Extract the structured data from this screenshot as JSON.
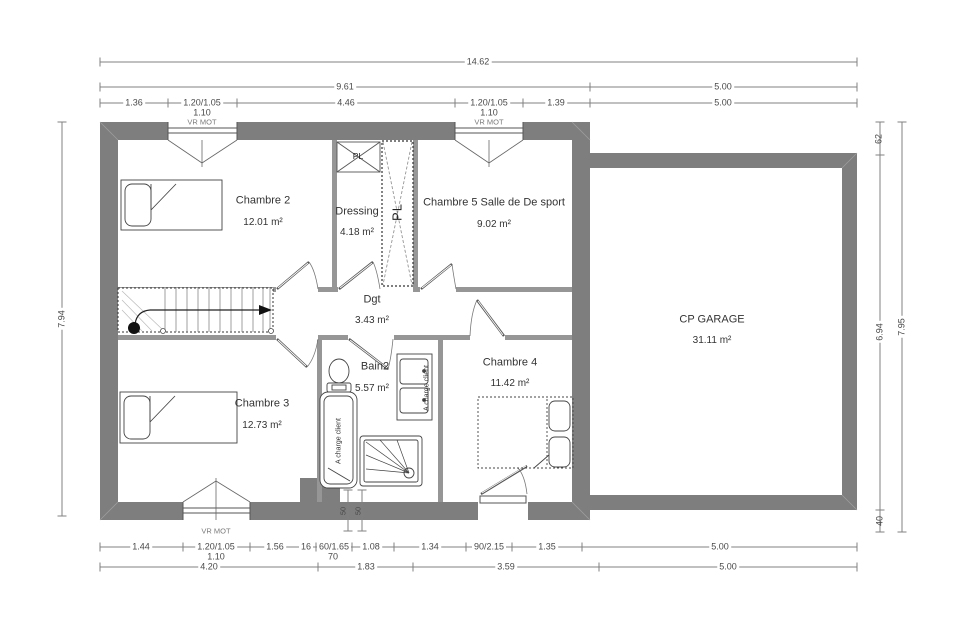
{
  "rooms": {
    "chambre2": {
      "name": "Chambre 2",
      "area": "12.01 m²"
    },
    "dressing": {
      "name": "Dressing",
      "area": "4.18 m²"
    },
    "chambre5": {
      "name": "Chambre 5 Salle de De sport",
      "area": "9.02 m²"
    },
    "dgt": {
      "name": "Dgt",
      "area": "3.43 m²"
    },
    "chambre3": {
      "name": "Chambre 3",
      "area": "12.73 m²"
    },
    "bain2": {
      "name": "Bain2",
      "area": "5.57 m²"
    },
    "chambre4": {
      "name": "Chambre 4",
      "area": "11.42 m²"
    },
    "garage": {
      "name": "CP GARAGE",
      "area": "31.11 m²"
    }
  },
  "closets": {
    "pl_box": "PL",
    "pl_column": "PL"
  },
  "fixtures": {
    "bathtub_note": "A charge client",
    "sink_note": "A charge client"
  },
  "windows": {
    "vr1": "VR MOT",
    "vr2": "VR MOT",
    "vr3": "VR MOT"
  },
  "dimensions": {
    "overall_width": "14.62",
    "top2_house": "9.61",
    "top2_garage": "5.00",
    "top3_1": "1.36",
    "top3_2": "1.20/1.05",
    "top3_2b": "1.10",
    "top3_3": "4.46",
    "top3_4": "1.20/1.05",
    "top3_4b": "1.10",
    "top3_5": "1.39",
    "top3_6": "5.00",
    "left_height": "7.94",
    "right_62": "62",
    "right_694": "6.94",
    "right_40": "40",
    "right_795": "7.95",
    "bot1_1": "1.44",
    "bot1_2": "1.20/1.05",
    "bot1_2b": "1.10",
    "bot1_3": "1.56",
    "bot1_4": "16",
    "bot1_5": "60/1.65",
    "bot1_5b": "70",
    "bot1_6": "1.08",
    "bot1_7": "1.34",
    "bot1_8": "90/2.15",
    "bot1_9": "1.35",
    "bot1_10": "5.00",
    "bot2_1": "4.20",
    "bot2_2": "1.83",
    "bot2_3": "3.59",
    "bot2_4": "5.00",
    "step_a": "50",
    "step_b": "50"
  },
  "colors": {
    "wall_gray": "#7e7e7e",
    "interior_wall_gray": "#969696",
    "dimension_gray": "#808080",
    "line_dark": "#3f3f3f"
  }
}
